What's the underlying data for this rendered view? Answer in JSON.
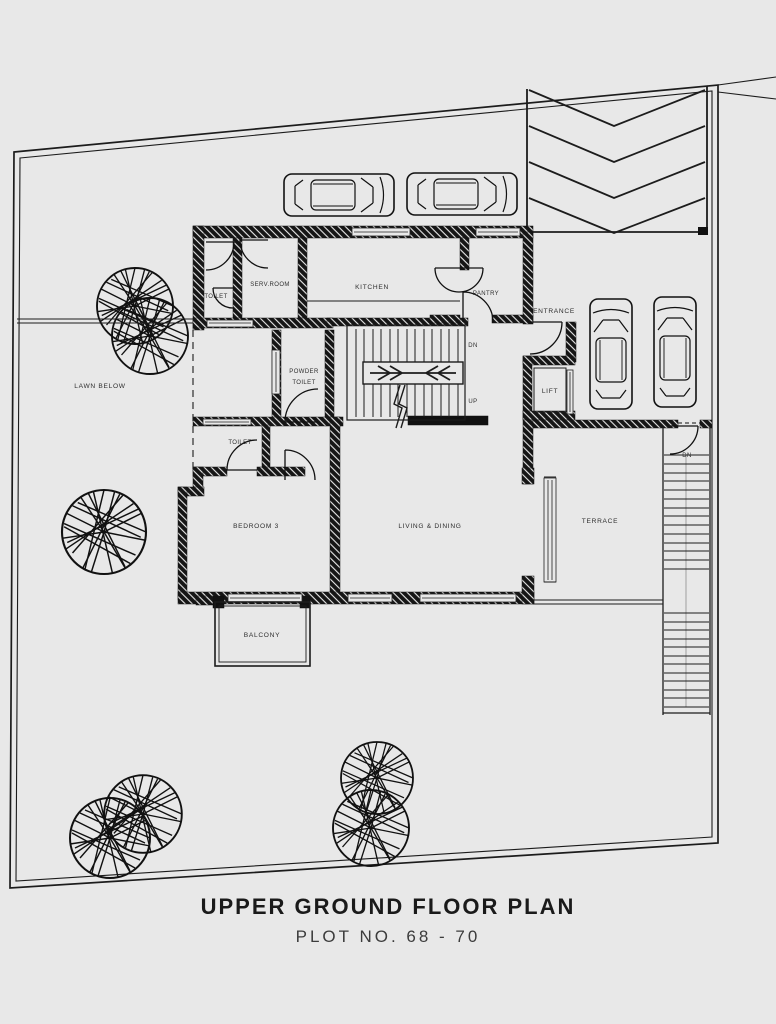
{
  "colors": {
    "background": "#e8e8e8",
    "line": "#1c1c1c",
    "wall": "#161616",
    "label": "#2e2e2e"
  },
  "title": {
    "main": "UPPER GROUND FLOOR PLAN",
    "subtitle": "PLOT NO. 68 - 70"
  },
  "rooms": {
    "toilet_top": "TOILET",
    "serv_room": "SERV.ROOM",
    "kitchen": "KITCHEN",
    "pantry": "PANTRY",
    "entrance": "ENTRANCE",
    "lift": "LIFT",
    "lawn": "LAWN BELOW",
    "powder_l1": "POWDER",
    "powder_l2": "TOILET",
    "toilet_mid": "TOILET",
    "bedroom": "BEDROOM 3",
    "living": "LIVING & DINING",
    "terrace": "TERRACE",
    "balcony": "BALCONY"
  },
  "stairs": {
    "dn": "DN",
    "up": "UP",
    "terrace_dn": "DN"
  }
}
